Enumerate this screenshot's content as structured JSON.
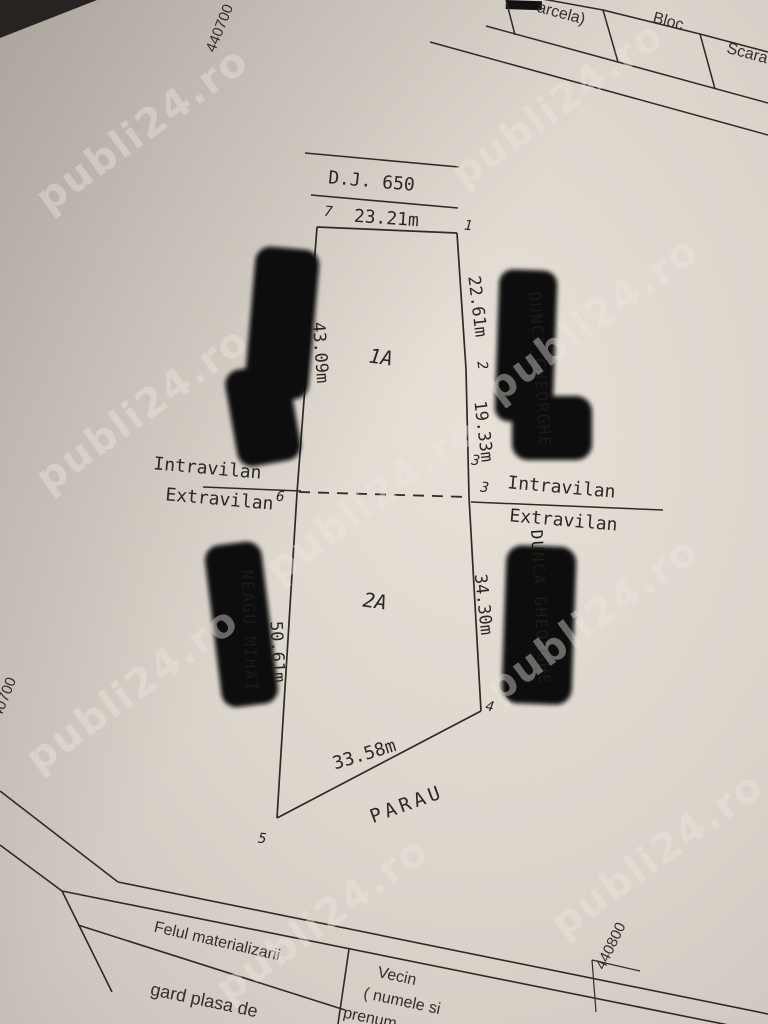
{
  "watermark": {
    "text": "publi24.ro"
  },
  "coordinates": {
    "top_left": "440700",
    "left_edge": "440700",
    "bottom_right": "440800"
  },
  "top_table": {
    "cell_parcela": "arcela)",
    "cell_bloc": "Bloc",
    "cell_scara": "Scara"
  },
  "plan": {
    "road_label": "D.J. 650",
    "parcel_upper": "1A",
    "parcel_lower": "2A",
    "stream": "PARAU",
    "points": {
      "p1": "1",
      "p2": "2",
      "p3a": "3",
      "p3b": "3",
      "p4": "4",
      "p5": "5",
      "p6": "6",
      "p7": "7"
    },
    "dims": {
      "top": "23.21m",
      "right_upper": "22.61m",
      "right_mid": "19.33m",
      "left_upper": "43.09m",
      "left_lower": "50.61m",
      "right_lower": "34.30m",
      "bottom": "33.58m"
    },
    "zones": {
      "left_in": "Intravilan",
      "left_ex": "Extravilan",
      "right_in": "Intravilan",
      "right_ex": "Extravilan"
    },
    "ghost_names": {
      "right_upper": "DUNCA GHEORGHE",
      "right_lower": "DUNCA GHEORGHE",
      "left_lower": "NEAGU MIHAI"
    }
  },
  "bottom_table": {
    "header_materialization": "Felul materializarii",
    "row_materialization": "gard plasa de",
    "header_neighbor_1": "Vecin",
    "header_neighbor_2": "( numele si",
    "header_neighbor_3": "prenum"
  },
  "colors": {
    "paper": "#dcd6cd",
    "ink": "#2e2a25",
    "redaction": "#0b0a09",
    "watermark": "#ece6dd"
  }
}
